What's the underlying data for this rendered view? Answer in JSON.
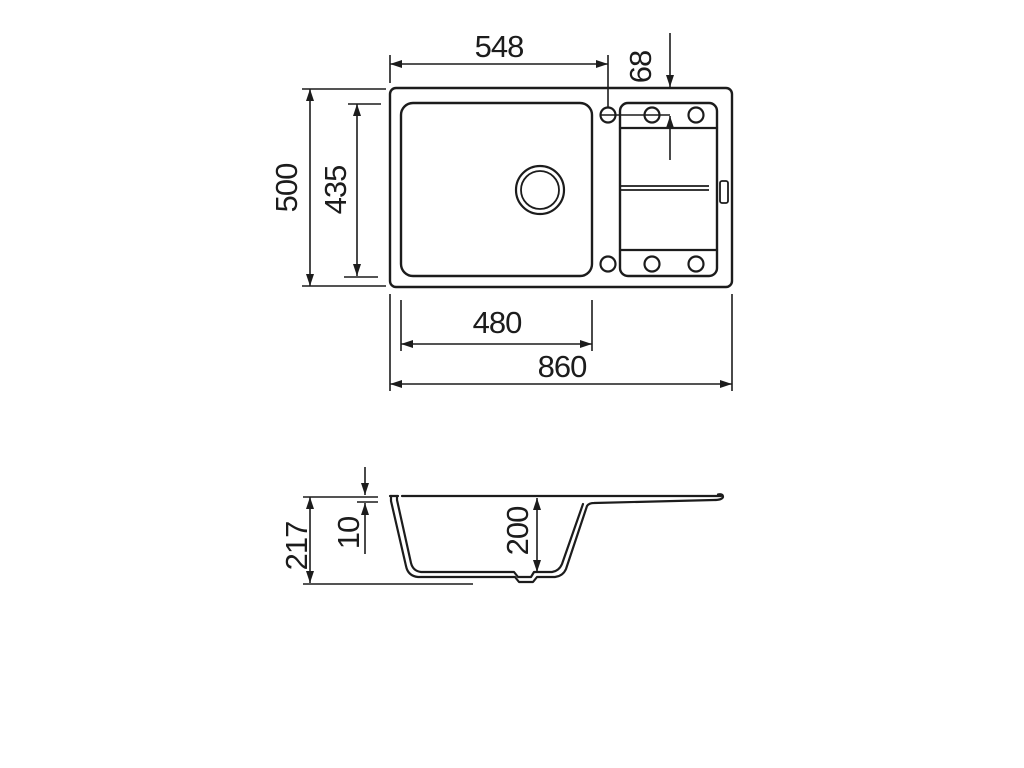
{
  "drawing": {
    "type": "technical-dimension-drawing",
    "subject": "kitchen sink with drainer",
    "units": "mm",
    "colors": {
      "line": "#1c1c1c",
      "background": "#ffffff"
    },
    "top_view": {
      "dimensions": {
        "rim_to_tap_hole_width": "548",
        "tap_hole_offset": "68",
        "overall_depth": "500",
        "bowl_front_to_back": "435",
        "bowl_width": "480",
        "overall_width": "860"
      },
      "features": {
        "tap_holes_top_row": 3,
        "tap_holes_bottom_row": 3,
        "drain_hole": 1,
        "overflow_slot": 1
      }
    },
    "section_view": {
      "dimensions": {
        "overall_height": "217",
        "rim_thickness": "10",
        "bowl_inner_depth": "200"
      }
    }
  }
}
